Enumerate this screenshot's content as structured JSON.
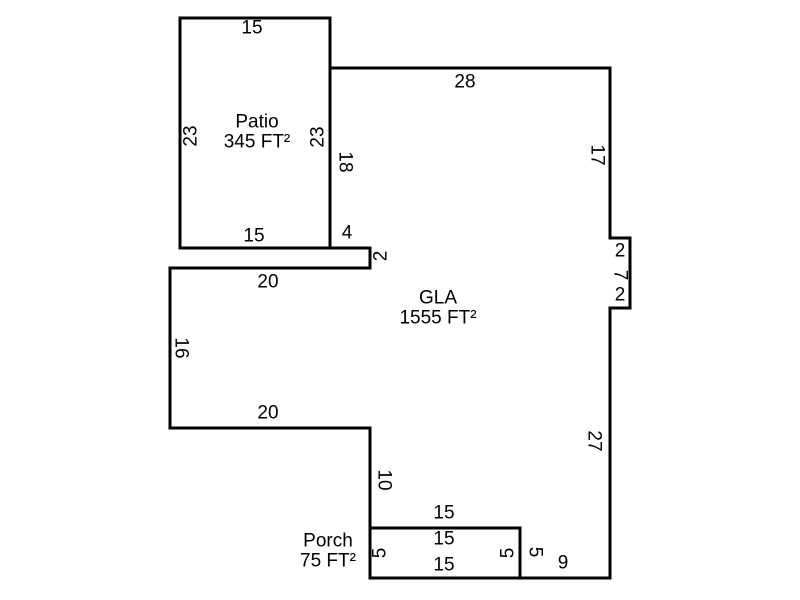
{
  "diagram": {
    "type": "floor-plan-sketch",
    "background_color": "#ffffff",
    "line_color": "#000000",
    "text_color": "#000000",
    "line_width": 3,
    "scale_px_per_ft": 10,
    "rooms": [
      {
        "id": "patio",
        "name": "Patio",
        "area_label": "345 FT²",
        "label_cx": 257,
        "label_cy": 132,
        "points": [
          [
            180,
            18
          ],
          [
            330,
            18
          ],
          [
            330,
            248
          ],
          [
            180,
            248
          ]
        ]
      },
      {
        "id": "gla",
        "name": "GLA",
        "area_label": "1555 FT²",
        "label_cx": 438,
        "label_cy": 308,
        "points": [
          [
            330,
            68
          ],
          [
            610,
            68
          ],
          [
            610,
            238
          ],
          [
            630,
            238
          ],
          [
            630,
            308
          ],
          [
            610,
            308
          ],
          [
            610,
            578
          ],
          [
            520,
            578
          ],
          [
            520,
            528
          ],
          [
            370,
            528
          ],
          [
            370,
            428
          ],
          [
            170,
            428
          ],
          [
            170,
            268
          ],
          [
            370,
            268
          ],
          [
            370,
            248
          ],
          [
            330,
            248
          ]
        ]
      },
      {
        "id": "porch",
        "name": "Porch",
        "area_label": "75 FT²",
        "label_cx": 328,
        "label_cy": 551,
        "points": [
          [
            370,
            528
          ],
          [
            520,
            528
          ],
          [
            520,
            578
          ],
          [
            370,
            578
          ]
        ]
      }
    ],
    "dimensions": [
      {
        "text": "15",
        "x": 252,
        "y": 28,
        "rot": 0,
        "wall": "patio-top"
      },
      {
        "text": "23",
        "x": 191,
        "y": 136,
        "rot": -90,
        "wall": "patio-left"
      },
      {
        "text": "23",
        "x": 318,
        "y": 137,
        "rot": -90,
        "wall": "patio-right"
      },
      {
        "text": "15",
        "x": 254,
        "y": 236,
        "rot": 0,
        "wall": "patio-bottom"
      },
      {
        "text": "28",
        "x": 465,
        "y": 82,
        "rot": 0,
        "wall": "gla-top"
      },
      {
        "text": "18",
        "x": 345,
        "y": 162,
        "rot": 90,
        "wall": "gla-left-upper"
      },
      {
        "text": "17",
        "x": 597,
        "y": 155,
        "rot": 90,
        "wall": "gla-right-upper"
      },
      {
        "text": "2",
        "x": 620,
        "y": 251,
        "rot": 0,
        "wall": "gla-notch-top"
      },
      {
        "text": "7",
        "x": 620,
        "y": 275,
        "rot": 90,
        "wall": "gla-notch-right"
      },
      {
        "text": "2",
        "x": 620,
        "y": 295,
        "rot": 0,
        "wall": "gla-notch-bottom"
      },
      {
        "text": "27",
        "x": 594,
        "y": 441,
        "rot": 90,
        "wall": "gla-right-lower"
      },
      {
        "text": "9",
        "x": 563,
        "y": 563,
        "rot": 0,
        "wall": "gla-bottom-right"
      },
      {
        "text": "5",
        "x": 535,
        "y": 552,
        "rot": 90,
        "wall": "gla-porch-side"
      },
      {
        "text": "15",
        "x": 444,
        "y": 513,
        "rot": 0,
        "wall": "gla-above-porch"
      },
      {
        "text": "10",
        "x": 384,
        "y": 480,
        "rot": 90,
        "wall": "gla-mid-left"
      },
      {
        "text": "20",
        "x": 268,
        "y": 413,
        "rot": 0,
        "wall": "gla-lower-left-bottom"
      },
      {
        "text": "16",
        "x": 181,
        "y": 348,
        "rot": 90,
        "wall": "gla-left-wall"
      },
      {
        "text": "20",
        "x": 268,
        "y": 282,
        "rot": 0,
        "wall": "gla-upper-left-top"
      },
      {
        "text": "2",
        "x": 381,
        "y": 256,
        "rot": -90,
        "wall": "gla-strip-right"
      },
      {
        "text": "4",
        "x": 347,
        "y": 233,
        "rot": 0,
        "wall": "gla-strip-top"
      },
      {
        "text": "15",
        "x": 444,
        "y": 539,
        "rot": 0,
        "wall": "porch-top"
      },
      {
        "text": "5",
        "x": 380,
        "y": 553,
        "rot": -90,
        "wall": "porch-left"
      },
      {
        "text": "15",
        "x": 444,
        "y": 565,
        "rot": 0,
        "wall": "porch-bottom"
      },
      {
        "text": "5",
        "x": 508,
        "y": 553,
        "rot": -90,
        "wall": "porch-right"
      }
    ]
  }
}
